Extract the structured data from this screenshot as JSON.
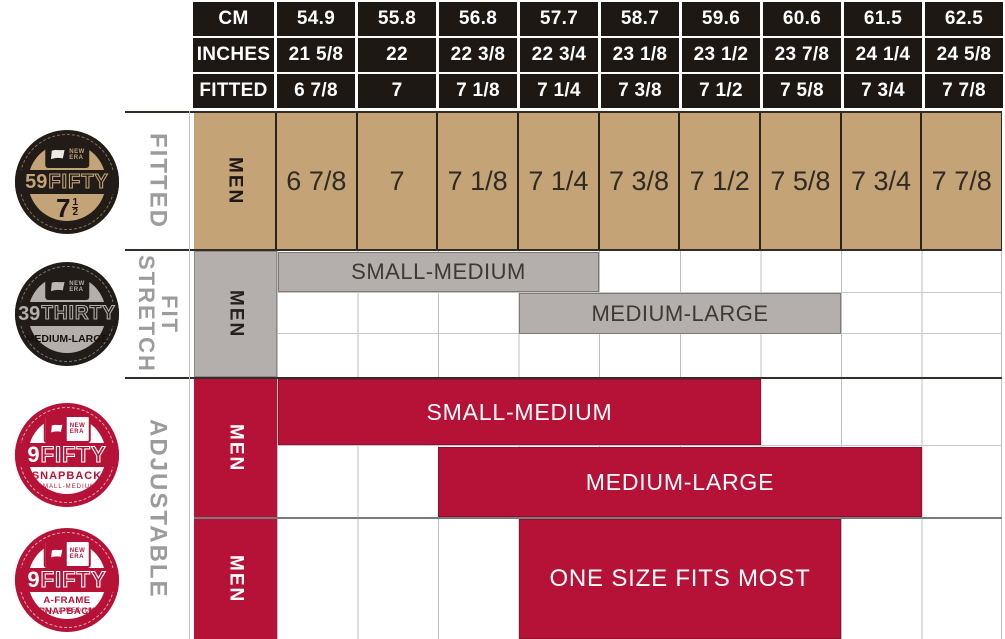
{
  "title": "New Era cap sizing chart",
  "colors": {
    "tan": "#C4A376",
    "gray": "#B4AFAC",
    "red": "#B61237",
    "header_black": "#1E1815",
    "label_gray": "#9C9C9C"
  },
  "header": {
    "rows": [
      {
        "label": "CM",
        "values": [
          "54.9",
          "55.8",
          "56.8",
          "57.7",
          "58.7",
          "59.6",
          "60.6",
          "61.5",
          "62.5"
        ]
      },
      {
        "label": "INCHES",
        "values": [
          "21 5/8",
          "22",
          "22 3/8",
          "22 3/4",
          "23 1/8",
          "23 1/2",
          "23 7/8",
          "24 1/4",
          "24 5/8"
        ]
      },
      {
        "label": "FITTED",
        "values": [
          "6 7/8",
          "7",
          "7 1/8",
          "7 1/4",
          "7 3/8",
          "7 1/2",
          "7 5/8",
          "7 3/4",
          "7 7/8"
        ]
      }
    ]
  },
  "sections": {
    "fitted": {
      "label": "FITTED",
      "men": "MEN",
      "sizes": [
        "6 7/8",
        "7",
        "7 1/8",
        "7 1/4",
        "7 3/8",
        "7 1/2",
        "7 5/8",
        "7 3/4",
        "7 7/8"
      ]
    },
    "stretch": {
      "label": "STRETCH FIT",
      "men": "MEN",
      "small_medium": "SMALL-MEDIUM",
      "medium_large": "MEDIUM-LARGE"
    },
    "adjustable": {
      "label": "ADJUSTABLE",
      "men_snapback": "MEN",
      "men_aframe": "MEN",
      "small_medium": "SMALL-MEDIUM",
      "medium_large": "MEDIUM-LARGE",
      "one_size": "ONE SIZE FITS MOST"
    }
  },
  "badges": {
    "fifty59": {
      "brand_top": "NEW",
      "brand_bottom": "ERA",
      "num": "59",
      "word": "FIFTY",
      "size_whole": "7",
      "size_frac_top": "1",
      "size_frac_bottom": "2",
      "size_cm": "59.6cm"
    },
    "thirty39": {
      "brand_top": "NEW",
      "brand_bottom": "ERA",
      "num": "39",
      "word": "THIRTY",
      "fit": "MEDIUM-LARGE"
    },
    "fifty9_snapback": {
      "brand_top": "NEW",
      "brand_bottom": "ERA",
      "num": "9",
      "word": "FIFTY",
      "style_label": "SNAPBACK",
      "fit": "SMALL-MEDIUM"
    },
    "fifty9_aframe": {
      "brand_top": "NEW",
      "brand_bottom": "ERA",
      "num": "9",
      "word": "FIFTY",
      "style_label": "A-FRAME SNAPBACK",
      "fit": "SMALL-MEDIUM"
    }
  },
  "chart_data": {
    "type": "table",
    "title": "New Era cap size chart",
    "columns": {
      "cm": [
        54.9,
        55.8,
        56.8,
        57.7,
        58.7,
        59.6,
        60.6,
        61.5,
        62.5
      ],
      "inches": [
        "21 5/8",
        "22",
        "22 3/8",
        "22 3/4",
        "23 1/8",
        "23 1/2",
        "23 7/8",
        "24 1/4",
        "24 5/8"
      ],
      "fitted": [
        "6 7/8",
        "7",
        "7 1/8",
        "7 1/4",
        "7 3/8",
        "7 1/2",
        "7 5/8",
        "7 3/4",
        "7 7/8"
      ]
    },
    "rows": [
      {
        "category": "FITTED",
        "product": "59FIFTY",
        "gender": "MEN",
        "ranges": [
          {
            "label": "fitted sizes",
            "from": "6 7/8",
            "to": "7 7/8"
          }
        ]
      },
      {
        "category": "STRETCH FIT",
        "product": "39THIRTY",
        "gender": "MEN",
        "ranges": [
          {
            "label": "SMALL-MEDIUM",
            "from": "6 7/8",
            "to": "7 1/4"
          },
          {
            "label": "MEDIUM-LARGE",
            "from": "7 1/4",
            "to": "7 5/8"
          }
        ]
      },
      {
        "category": "ADJUSTABLE",
        "product": "9FIFTY SNAPBACK",
        "gender": "MEN",
        "ranges": [
          {
            "label": "SMALL-MEDIUM",
            "from": "6 7/8",
            "to": "7 1/2"
          },
          {
            "label": "MEDIUM-LARGE",
            "from": "7 1/8",
            "to": "7 3/4"
          }
        ]
      },
      {
        "category": "ADJUSTABLE",
        "product": "9FIFTY A-FRAME SNAPBACK",
        "gender": "MEN",
        "ranges": [
          {
            "label": "ONE SIZE FITS MOST",
            "from": "7 1/4",
            "to": "7 5/8"
          }
        ]
      }
    ]
  }
}
